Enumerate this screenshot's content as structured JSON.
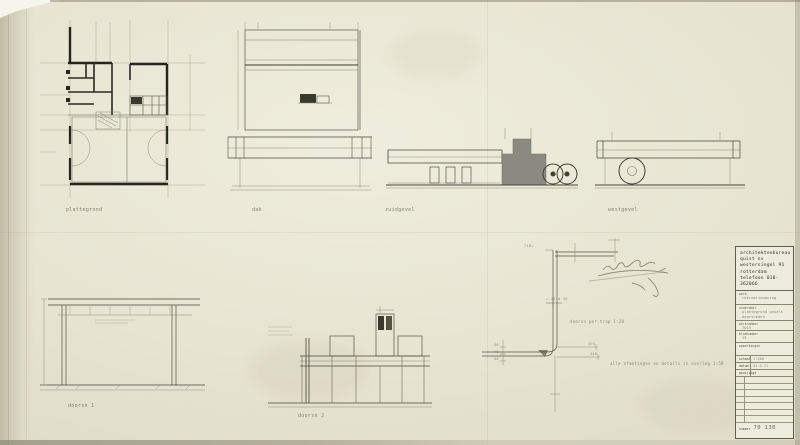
{
  "sheet": {
    "drawing_labels": {
      "plan": "plattegrond",
      "roof": "dak",
      "south_elevation": "zuidgevel",
      "west_elevation": "westgevel",
      "section_1": "doorsn 1",
      "section_2": "doorsn 2",
      "stair_detail": "doorsn per trap 1:20",
      "general_note": "alle afmetingen en details in overleg  1:50"
    },
    "dims": {
      "d748": "748+",
      "d25d46": "+ 25 d 46",
      "d495": "495",
      "d346": "346",
      "d40a": "40",
      "d40b": "40",
      "d40c": "40"
    }
  },
  "title_block": {
    "firm_lines": [
      "architektenbureau",
      "quist nv",
      "westersingel 91",
      "rotterdam",
      "telefoon 010-362066"
    ],
    "fields": [
      {
        "label": "werk",
        "line1": "rekreatiewoning",
        "line2": ""
      },
      {
        "label": "onderdeel",
        "line1": "plattegrond gevels",
        "line2": "doorsneden"
      },
      {
        "label": "werknummer",
        "line1": "7015",
        "line2": ""
      },
      {
        "label": "bladnummer",
        "line1": "15",
        "line2": ""
      },
      {
        "label": "opmerkingen",
        "line1": "",
        "line2": ""
      }
    ],
    "meta": [
      {
        "label": "schaal",
        "value": "1:100"
      },
      {
        "label": "datum",
        "value": "24-6-71"
      },
      {
        "label": "gewijzigd",
        "value": ""
      }
    ],
    "number_label": "nummer",
    "number_value": "70 130"
  }
}
